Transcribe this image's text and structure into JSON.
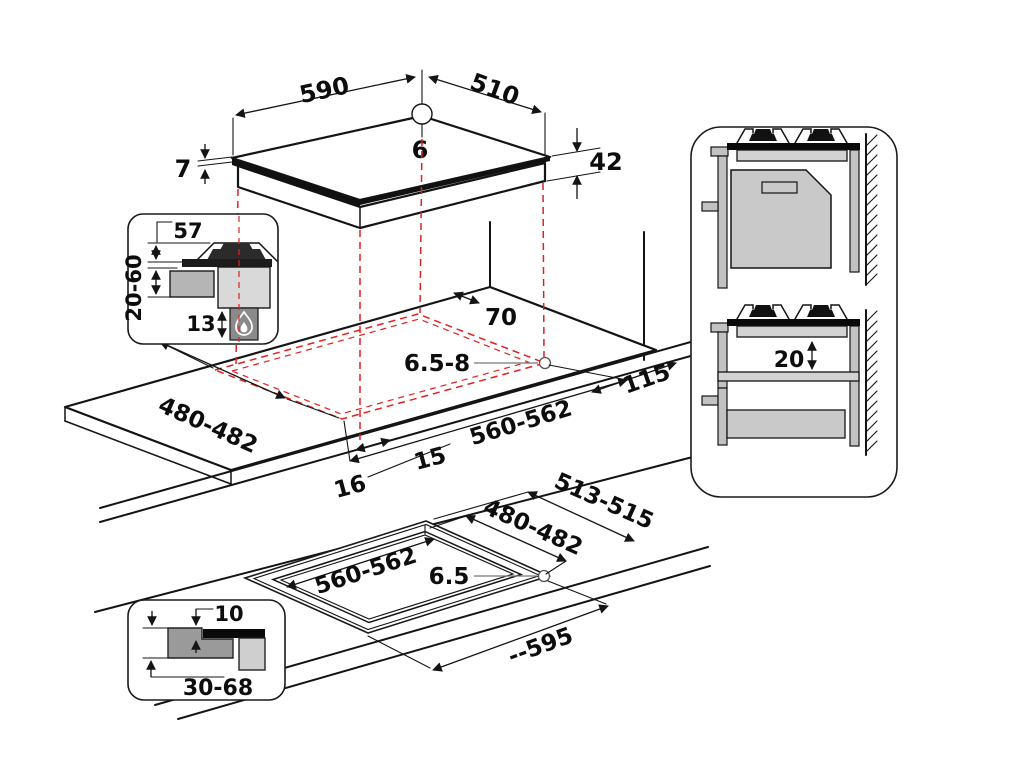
{
  "figure": {
    "kind": "hob-installation-dimension-diagram",
    "colors": {
      "line": "#141414",
      "red_dashed": "#e02020",
      "gray_light": "#d2d2d2",
      "gray_mid": "#b5b5b5",
      "gray_dark": "#8a8a8a"
    },
    "labels": {
      "hob_width": "590",
      "hob_depth": "510",
      "hole_dia": "6",
      "glass_thickness": "7",
      "total_height": "42",
      "burner_height": "57",
      "worktop_thickness": "20-60",
      "gas_clearance": "13",
      "rear_clearance": "70",
      "corner_radius_range": "6.5-8",
      "side_clearance": "115",
      "cutout_depth": "480-482",
      "cutout_width": "560-562",
      "front_clearance_a": "15",
      "front_clearance_b": "16",
      "flush_cutout_width": "560-562",
      "flush_cutout_depth": "480-482",
      "flush_outer_depth": "513-515",
      "flush_corner_radius": "6.5",
      "flush_outer_width": "--595",
      "flush_rebate": "10",
      "flush_worktop_range": "30-68",
      "undershelf_gap": "20"
    },
    "icons": [
      "flame-icon",
      "burner-icon",
      "wall-hatch-icon"
    ]
  }
}
